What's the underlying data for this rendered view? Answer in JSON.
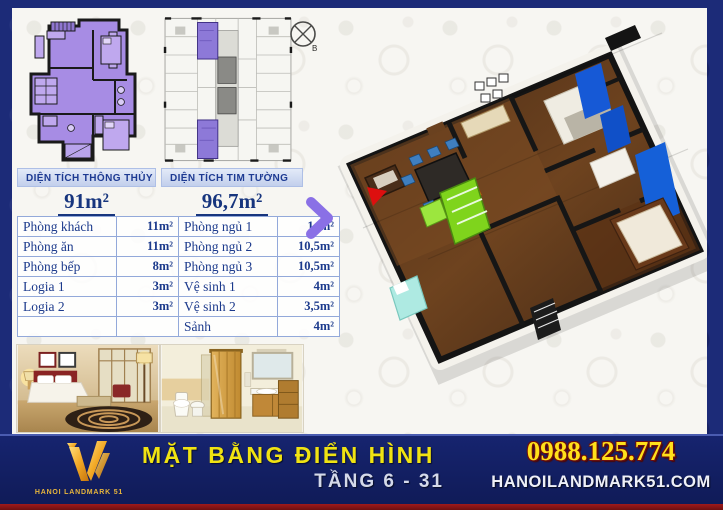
{
  "area_summary": {
    "left": {
      "header": "DIỆN TÍCH THÔNG THỦY",
      "value": "91m²"
    },
    "right": {
      "header": "DIỆN TÍCH TIM TƯỜNG",
      "value": "96,7m²"
    }
  },
  "room_table": {
    "left_rows": [
      {
        "label": "Phòng khách",
        "value": "11m²"
      },
      {
        "label": "Phòng ăn",
        "value": "11m²"
      },
      {
        "label": "Phòng bếp",
        "value": "8m²"
      },
      {
        "label": "Logia 1",
        "value": "3m²"
      },
      {
        "label": "Logia 2",
        "value": "3m²"
      },
      {
        "label": "",
        "value": ""
      }
    ],
    "right_rows": [
      {
        "label": "Phòng ngủ 1",
        "value": "14m²"
      },
      {
        "label": "Phòng ngủ 2",
        "value": "10,5m²"
      },
      {
        "label": "Phòng ngủ 3",
        "value": "10,5m²"
      },
      {
        "label": "Vệ sinh 1",
        "value": "4m²"
      },
      {
        "label": "Vệ sinh 2",
        "value": "3,5m²"
      },
      {
        "label": "Sảnh",
        "value": "4m²"
      }
    ]
  },
  "plans": {
    "compass_label": "B"
  },
  "footer": {
    "logo_text": "HANOI LANDMARK 51",
    "title": "MẶT BẰNG ĐIỂN HÌNH",
    "subtitle": "TẦNG 6 - 31",
    "phone": "0988.125.774",
    "website": "HANOILANDMARK51.COM"
  },
  "colors": {
    "navy_frame": "#1c2b78",
    "footer_navy": "#16246f",
    "gold": "#e8a820",
    "title_yellow": "#f0e312",
    "phone_yellow": "#ffe01a",
    "red_strip": "#8a1515",
    "plan_purple": "#a78ce4",
    "header_bar_blue": "#cdd9f0",
    "table_text_navy": "#1c3a8c",
    "accent_blue_3d": "#1560d8",
    "lime_green": "#7fd41c"
  }
}
